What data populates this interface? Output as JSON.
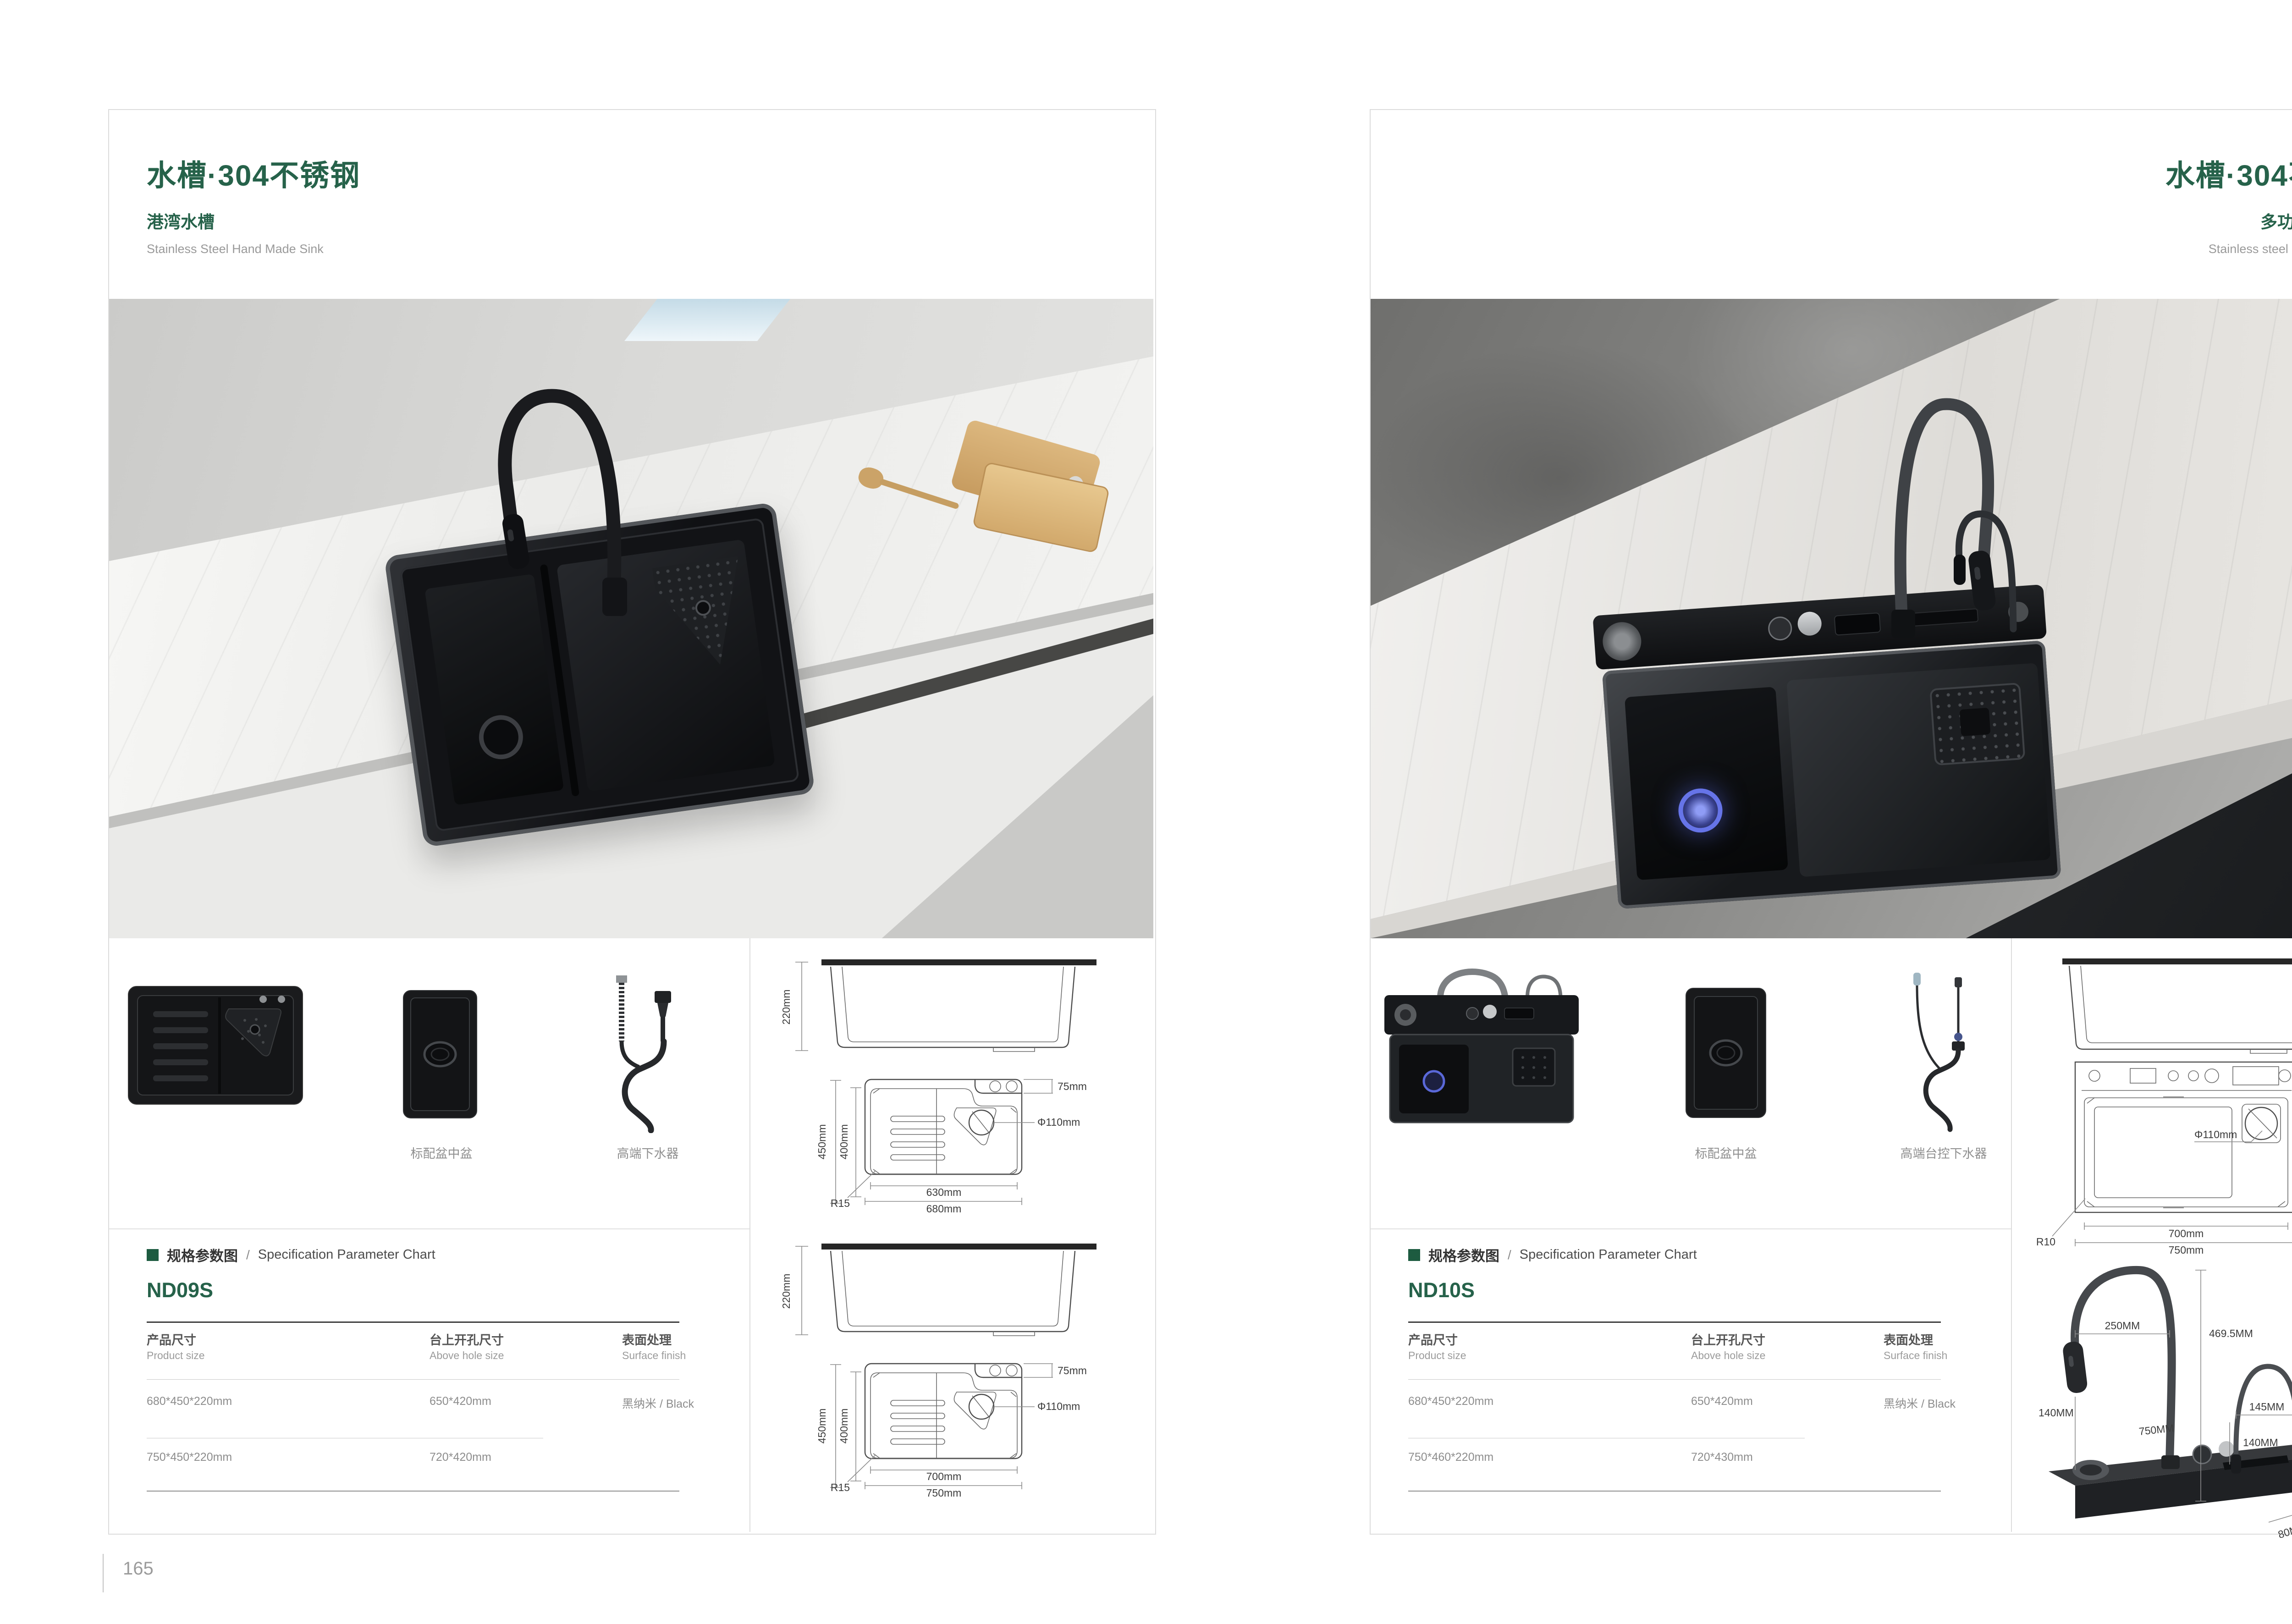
{
  "left_page": {
    "title": "水槽·304不锈钢",
    "series_cn": "港湾水槽",
    "series_en": "Stainless Steel Hand Made Sink",
    "page_number": "165",
    "captions": {
      "basin_in_basin": "标配盆中盆",
      "drain_kit": "高端下水器"
    },
    "spec": {
      "heading_cn": "规格参数图",
      "heading_sep": "/",
      "heading_en": "Specification Parameter Chart",
      "model": "ND09S",
      "columns": [
        {
          "cn": "产品尺寸",
          "en": "Product size"
        },
        {
          "cn": "台上开孔尺寸",
          "en": "Above hole size"
        },
        {
          "cn": "表面处理",
          "en": "Surface finish"
        }
      ],
      "rows": [
        {
          "size": "680*450*220mm",
          "hole": "650*420mm",
          "finish": "黑纳米 / Black"
        },
        {
          "size": "750*450*220mm",
          "hole": "720*420mm",
          "finish": ""
        }
      ]
    },
    "drawings": {
      "side1": {
        "height": "220mm"
      },
      "top1": {
        "outer_h": "450mm",
        "inner_h": "400mm",
        "deck": "75mm",
        "drain": "Φ110mm",
        "radius": "R15",
        "inner_w": "630mm",
        "outer_w": "680mm"
      },
      "side2": {
        "height": "220mm"
      },
      "top2": {
        "outer_h": "450mm",
        "inner_h": "400mm",
        "deck": "75mm",
        "drain": "Φ110mm",
        "radius": "R15",
        "inner_w": "700mm",
        "outer_w": "750mm"
      }
    }
  },
  "right_page": {
    "title": "水槽·304不锈钢",
    "series_cn": "多功能一体水槽",
    "series_en": "Stainless steel hand made sink",
    "page_number": "166",
    "captions": {
      "basin_in_basin": "标配盆中盆",
      "drain_kit": "高端台控下水器"
    },
    "spec": {
      "heading_cn": "规格参数图",
      "heading_sep": "/",
      "heading_en": "Specification Parameter Chart",
      "model": "ND10S",
      "columns": [
        {
          "cn": "产品尺寸",
          "en": "Product size"
        },
        {
          "cn": "台上开孔尺寸",
          "en": "Above hole size"
        },
        {
          "cn": "表面处理",
          "en": "Surface finish"
        }
      ],
      "rows": [
        {
          "size": "680*450*220mm",
          "hole": "650*420mm",
          "finish": "黑纳米 / Black"
        },
        {
          "size": "750*460*220mm",
          "hole": "720*430mm",
          "finish": ""
        }
      ]
    },
    "drawings": {
      "side1": {
        "height": "220mm"
      },
      "top1": {
        "deck_h": "80mm",
        "basin_h": "355mm",
        "outer_h": "460mm",
        "drain": "Φ110mm",
        "radius": "R10",
        "inner_w": "700mm",
        "outer_w": "750mm"
      },
      "faucet": {
        "reach": "250MM",
        "height": "469.5MM",
        "clearance": "140MM",
        "length": "750MM",
        "small_reach": "145MM",
        "small_clearance": "140MM",
        "small_height": "225MM",
        "body_height": "40MM",
        "body_depth": "80MM"
      }
    }
  },
  "colors": {
    "accent_green": "#26624a",
    "bullet_green": "#1d5b40",
    "text_gray": "#8f8f8f"
  }
}
